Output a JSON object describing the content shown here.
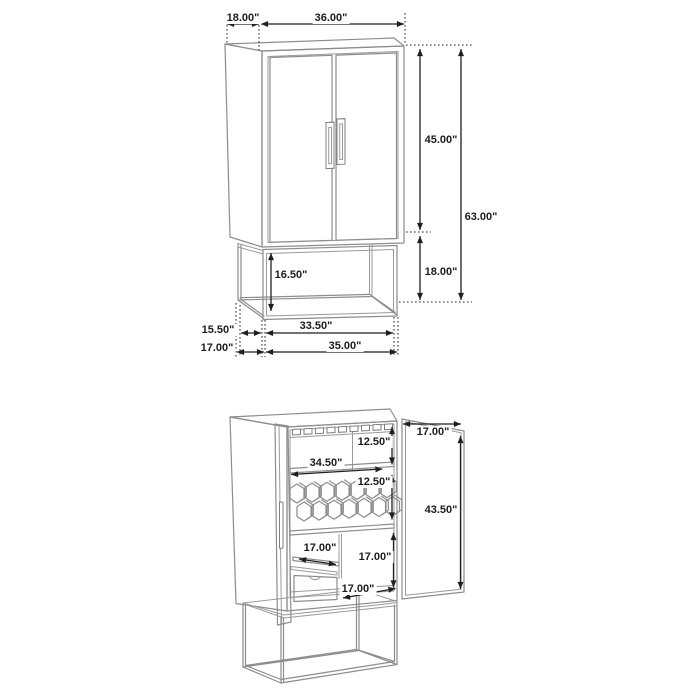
{
  "colors": {
    "background": "#ffffff",
    "furniture_line_art": "#8d8d8d",
    "dimension_lines_text": "#1f1f1f"
  },
  "top_view": {
    "overall_depth": "18.00\"",
    "overall_width": "36.00\"",
    "cabinet_height": "45.00\"",
    "overall_height": "63.00\"",
    "base_height": "18.00\"",
    "base_clearance_height": "16.50\"",
    "base_top_depth": "15.50\"",
    "base_top_width": "33.50\"",
    "base_bottom_depth": "17.00\"",
    "base_bottom_width": "35.00\""
  },
  "bottom_view": {
    "door_width": "17.00\"",
    "stemware_section_height": "12.50\"",
    "shelf_width": "34.50\"",
    "wine_rack_section_height": "12.50\"",
    "door_height": "43.50\"",
    "drawer_width": "17.00\"",
    "lower_section_height": "17.00\"",
    "lower_section_depth": "17.00\""
  }
}
